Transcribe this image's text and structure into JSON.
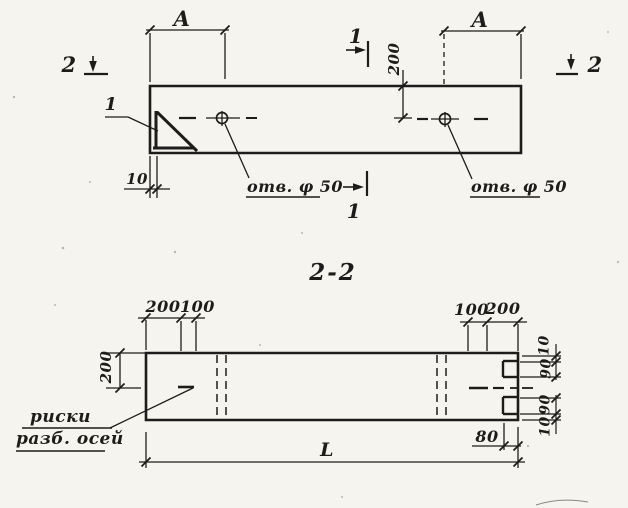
{
  "drawing_title": "precast beam shop drawing, plan and section 2-2",
  "colors": {
    "ink": "#1d1c1a",
    "paper": "#f5f4ef"
  },
  "plan": {
    "dim_a_left": "A",
    "dim_a_right": "A",
    "dim_edge_to_hole_axis": "200",
    "dim_corner_gap": "10",
    "hole_label_left": "отв. φ 50",
    "hole_label_right": "отв. φ 50",
    "section_mark_1_top": "1",
    "section_mark_1_bottom": "1",
    "section_mark_2_left": "2",
    "section_mark_2_right": "2",
    "detail_mark": "1"
  },
  "section": {
    "title": "2-2",
    "dim_top_left_200": "200",
    "dim_top_left_100": "100",
    "dim_top_right_100": "100",
    "dim_top_right_200": "200",
    "dim_left_edge_to_axis": "200",
    "dim_right_top_10": "10",
    "dim_right_top_90": "90",
    "dim_right_bottom_90": "90",
    "dim_right_bottom_10": "10",
    "dim_notch_depth": "80",
    "dim_length": "L",
    "axis_note_line1": "риски",
    "axis_note_line2": "разб. осей"
  }
}
